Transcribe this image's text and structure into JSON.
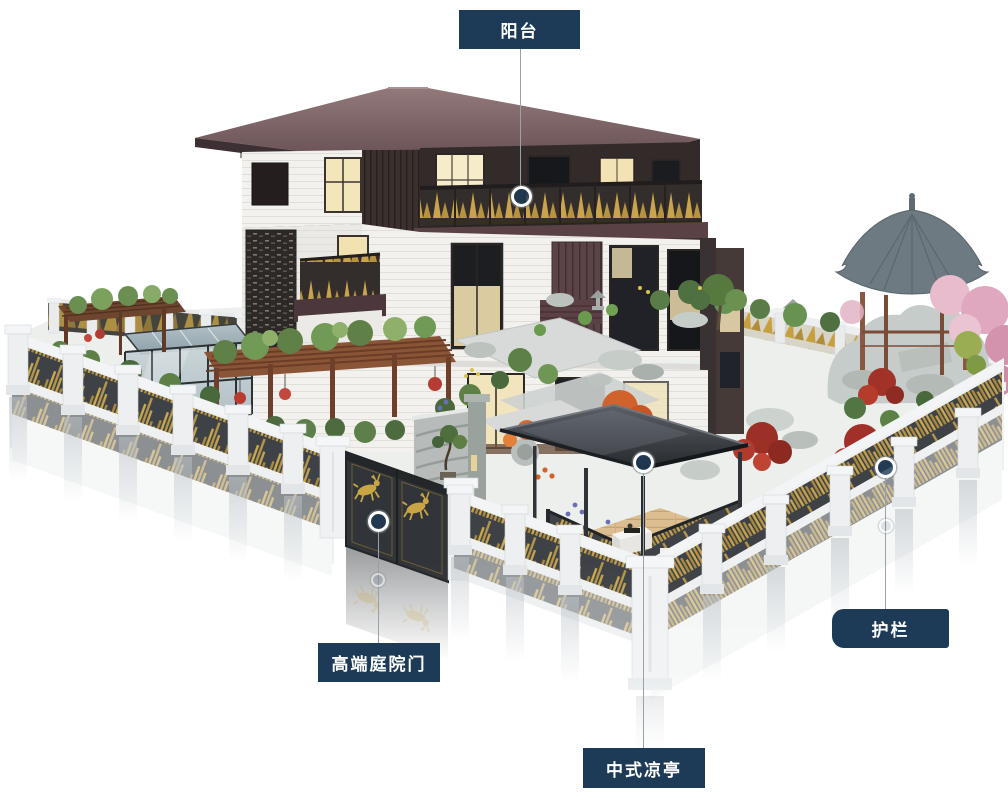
{
  "page": {
    "background": "#ffffff"
  },
  "annotations": {
    "balcony": {
      "label": "阳台"
    },
    "gate": {
      "label": "高端庭院门"
    },
    "pavilion": {
      "label": "中式凉亭"
    },
    "railing": {
      "label": "护栏"
    }
  },
  "colors": {
    "label_background": "#1d3b57",
    "label_text": "#ffffff",
    "leader_line": "#97a2ab",
    "marker_fill": "rgba(29,59,87,0.8)",
    "marker_ring": "#ffffff",
    "fence_gold": "#c3a150",
    "roof_maroon": "#5d474b",
    "pavilion_roof": "#33363b",
    "gazebo_roof": "#6e7a82",
    "foliage_green": "#5d8046",
    "maple_red": "#a23227",
    "maple_orange": "#d2622c",
    "blossom_pink": "#dfa8bf",
    "deck_wood": "#dcbe90"
  }
}
